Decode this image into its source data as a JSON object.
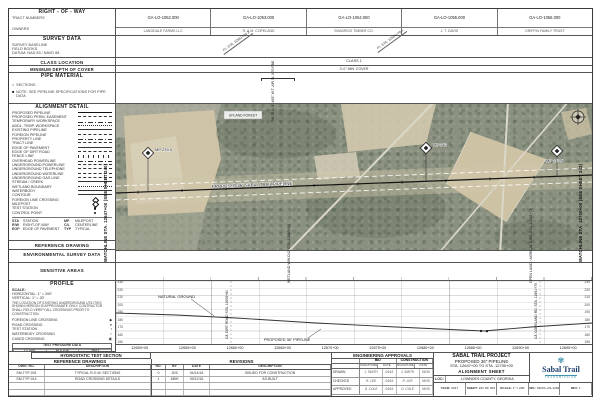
{
  "sheet": {
    "matchline_left": "MATCHLINE STA. 12647+00 (SEE SHEET 240)",
    "matchline_right": "MATCHLINE STA. 12700+00 (SEE SHEET 242)"
  },
  "sidebar": {
    "right_of_way": {
      "title": "RIGHT - OF - WAY",
      "lines": [
        "TRACT NUMBERS",
        "OWNERS"
      ]
    },
    "survey_data": {
      "title": "SURVEY DATA",
      "lines": [
        "SURVEY BASELINE",
        "FIELD BOOKS",
        "DATUM: NAD 83 / NAVD 88"
      ]
    },
    "class_location": "CLASS LOCATION",
    "min_depth": "MINIMUM DEPTH OF COVER",
    "pipe_material": {
      "title": "PIPE MATERIAL",
      "items": [
        {
          "sym": "○",
          "label": "SECTIONS"
        },
        {
          "sym": "■",
          "label": "NOTE: SEE PIPELINE SPECIFICATIONS FOR PIPE DATA"
        }
      ]
    },
    "alignment_detail": {
      "title": "ALIGNMENT DETAIL",
      "legend": [
        {
          "label": "PROPOSED PIPELINE",
          "s": "thick"
        },
        {
          "label": "PROPOSED PERM. EASEMENT",
          "s": "dash"
        },
        {
          "label": "TEMPORARY WORKSPACE",
          "s": "dashdot"
        },
        {
          "label": "ADDL. TEMP. WORKSPACE",
          "s": "dot"
        },
        {
          "label": "EXISTING PIPELINE",
          "s": "thin"
        },
        {
          "label": "FOREIGN PIPELINE",
          "s": "dash"
        },
        {
          "label": "PROPERTY LINE",
          "s": "dashdot"
        },
        {
          "label": "TRACT LINE",
          "s": "dash"
        },
        {
          "label": "EDGE OF PAVEMENT",
          "s": "thin"
        },
        {
          "label": "EDGE OF DIRT ROAD",
          "s": "dash"
        },
        {
          "label": "FENCE LINE",
          "s": "ticks"
        },
        {
          "label": "OVERHEAD POWERLINE",
          "s": "dashdot"
        },
        {
          "label": "UNDERGROUND POWERLINE",
          "s": "dash"
        },
        {
          "label": "UNDERGROUND TELEPHONE",
          "s": "dash"
        },
        {
          "label": "UNDERGROUND WATERLINE",
          "s": "dash"
        },
        {
          "label": "UNDERGROUND GAS LINE",
          "s": "dash"
        },
        {
          "label": "STREAM / CREEK",
          "s": "thin"
        },
        {
          "label": "WETLAND BOUNDARY",
          "s": "dot"
        },
        {
          "label": "WATERBODY",
          "s": "thin"
        },
        {
          "label": "CONTOUR",
          "s": "thin"
        },
        {
          "label": "FOREIGN LINE CROSSING",
          "s": "diamond"
        },
        {
          "label": "MILEPOST",
          "s": "diamond"
        },
        {
          "label": "TEST STATION",
          "s": "dotsym"
        },
        {
          "label": "CONTROL POINT",
          "s": "dotsym"
        }
      ],
      "abbr": [
        {
          "k": "STA",
          "v": "STATION"
        },
        {
          "k": "MP",
          "v": "MILEPOST"
        },
        {
          "k": "R/W",
          "v": "RIGHT-OF-WAY"
        },
        {
          "k": "C/L",
          "v": "CENTERLINE"
        },
        {
          "k": "EOP",
          "v": "EDGE OF PAVEMENT"
        },
        {
          "k": "TYP",
          "v": "TYPICAL"
        }
      ]
    },
    "reference_drawing": "REFERENCE DRAWING",
    "environmental": "ENVIRONMENTAL SURVEY DATA",
    "sensitive": "SENSITIVE AREAS",
    "profile": {
      "title": "PROFILE",
      "scale_label": "SCALE:",
      "scale_h": "HORIZONTAL: 1\" = 200'",
      "scale_v": "VERTICAL: 1\" = 20'",
      "note": "THE LOCATION OF EXISTING UNDERGROUND UTILITIES SHOWN HEREON IS APPROXIMATE ONLY. CONTRACTOR SHALL FIELD VERIFY ALL CROSSINGS PRIOR TO CONSTRUCTION.",
      "legend": [
        {
          "sym": "◆",
          "label": "FOREIGN LINE CROSSING"
        },
        {
          "sym": "●",
          "label": "ROAD CROSSING"
        },
        {
          "sym": "▪",
          "label": "TEST STATION"
        },
        {
          "sym": "○",
          "label": "WATERBODY CROSSING"
        },
        {
          "sym": "▣",
          "label": "CASED CROSSING"
        }
      ],
      "table": {
        "title": "TEST PRESSURE DATA",
        "cols": [
          "CLASS",
          "M.A.O.P.",
          "TEST"
        ],
        "rows": [
          {
            "a": "1",
            "b": "1,456 PSIG",
            "c": "1,600 PSIG"
          }
        ]
      }
    },
    "hydrostatic": "HYDROSTATIC TEST SECTION"
  },
  "strips": {
    "tracts": [
      {
        "id": "GA-LO-1052.000",
        "owner": "LANGDALE FARMS LLC"
      },
      {
        "id": "GA-LO-1053.000",
        "owner": "R. & M. COPELAND"
      },
      {
        "id": "GA-LO-1054.000",
        "owner": "SHADRICK TIMBER CO."
      },
      {
        "id": "GA-LO-1055.000",
        "owner": "J. T. DAVIS"
      },
      {
        "id": "GA-LO-1056.000",
        "owner": "GRIFFIN FAMILY TRUST"
      }
    ],
    "survey_note_1": "P.I. STA. 12661+24.3",
    "survey_note_2": "P.I. STA. 12684+70.1",
    "class_note": "CLASS 1",
    "cover_note": "3'-0\" MIN. COVER",
    "pipe_note": "36\" O.D. x .465\" W.T. API 5L X70 FBE",
    "env_note": "WETLAND WW-D42 STA. 12665+10",
    "sensitive_note": "OPEN LAND / AGRICULTURE STA. 12691+75"
  },
  "map": {
    "pipeline_label": "PROPOSED 36\" SABAL TRAIL PIPELINE",
    "area_label": "UPLAND FOREST",
    "mileposts": [
      {
        "label": "MP 239.5"
      },
      {
        "label": "MP 240"
      },
      {
        "label": "MP 240.5"
      }
    ]
  },
  "profile_plot": {
    "elevations": [
      "230",
      "220",
      "210",
      "200",
      "190",
      "180",
      "170",
      "160",
      "150"
    ],
    "stations": [
      "12650+00",
      "12655+00",
      "12660+00",
      "12665+00",
      "12670+00",
      "12675+00",
      "12680+00",
      "12685+00",
      "12690+00",
      "12695+00"
    ],
    "ground_label": "NATURAL GROUND",
    "pipe_label": "PROPOSED 36\" PIPELINE",
    "xing_left": "C/L DIRT ROAD STA. 12659+80",
    "xing_right": "C/L COPELAND RD. STA. 12691+75"
  },
  "tables": {
    "reference": {
      "title": "REFERENCE DRAWINGS",
      "col_no": "DWG. NO.",
      "col_desc": "DESCRIPTION",
      "rows": [
        {
          "no": "SM-TYP-001",
          "desc": "TYPICAL R.O.W. SECTIONS"
        },
        {
          "no": "SM-TYP-014",
          "desc": "ROAD CROSSING DETAILS"
        },
        {
          "no": "",
          "desc": ""
        },
        {
          "no": "",
          "desc": ""
        }
      ]
    },
    "revisions": {
      "title": "REVISIONS",
      "col_no": "NO.",
      "col_by": "BY",
      "col_date": "DATE",
      "col_desc": "DESCRIPTION",
      "rows": [
        {
          "no": "0",
          "by": "JDS",
          "date": "04/14/16",
          "desc": "ISSUED FOR CONSTRUCTION"
        },
        {
          "no": "1",
          "by": "MBH",
          "date": "09/12/16",
          "desc": "AS-BUILT"
        },
        {
          "no": "",
          "by": "",
          "date": "",
          "desc": ""
        },
        {
          "no": "",
          "by": "",
          "date": "",
          "desc": ""
        }
      ]
    },
    "approvals": {
      "title": "ENGINEERING APPROVALS",
      "groups": [
        "BID",
        "CONSTRUCTION"
      ],
      "sub": [
        "SIGNATURE",
        "DATE",
        "SIGNATURE",
        "DATE"
      ],
      "rows": [
        {
          "label": "DRAWN",
          "b_sig": "J. SMITH",
          "b_date": "04/16",
          "c_sig": "J. SMITH",
          "c_date": "09/16"
        },
        {
          "label": "CHECKED",
          "b_sig": "R. LEE",
          "b_date": "04/16",
          "c_sig": "R. LEE",
          "c_date": "09/16"
        },
        {
          "label": "APPROVED",
          "b_sig": "D. COLE",
          "b_date": "04/16",
          "c_sig": "D. COLE",
          "c_date": "09/16"
        }
      ]
    }
  },
  "title_block": {
    "project": "SABAL TRAIL PROJECT",
    "line2": "PROPOSED 36\" PIPELINE",
    "line3": "STA. 12647+00 TO STA. 12700+00",
    "line4": "ALIGNMENT SHEET",
    "loc_label": "LOC:",
    "loc_value": "LOWNDES COUNTY, GEORGIA",
    "fields": [
      {
        "label": "YEAR:",
        "value": "2017"
      },
      {
        "label": "SHEET:",
        "value": "241 OF 363"
      },
      {
        "label": "SCALE:",
        "value": "1\" = 200'"
      },
      {
        "label": "DWG:",
        "value": "SM-PL-AS-12647"
      },
      {
        "label": "REV:",
        "value": "1"
      }
    ]
  },
  "logo": {
    "mark": "✾",
    "name": "Sabal Trail",
    "sub": "TRANSMISSION"
  }
}
